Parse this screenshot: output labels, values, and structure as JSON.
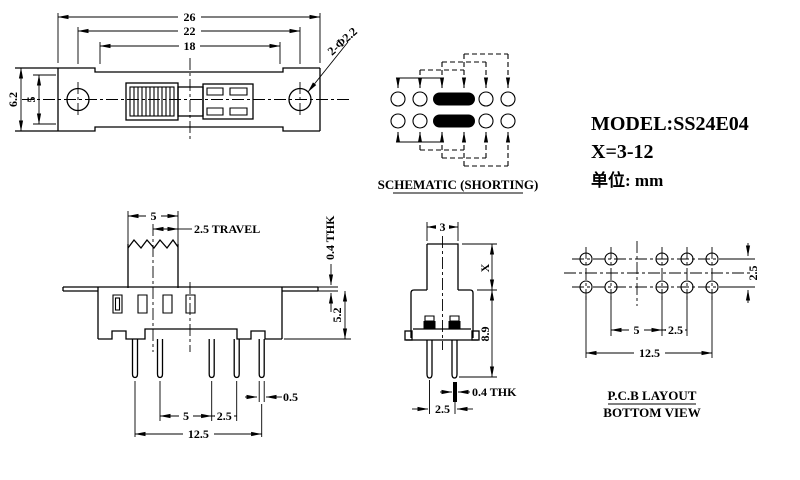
{
  "colors": {
    "ink": "#000000",
    "background": "#ffffff"
  },
  "title_block": {
    "model": "MODEL:SS24E04",
    "x_range": "X=3-12",
    "units": "单位: mm"
  },
  "top_view": {
    "dim_26": "26",
    "dim_22": "22",
    "dim_18": "18",
    "dim_62": "6.2",
    "dim_5": "5",
    "hole_callout": "2-Φ2.2"
  },
  "schematic": {
    "caption": "SCHEMATIC (SHORTING)"
  },
  "front_view": {
    "dim_knob": "5",
    "dim_travel": "2.5 TRAVEL",
    "dim_thk": "0.4 THK",
    "dim_height": "5.2",
    "dim_pitch5": "5",
    "dim_pitch25": "2.5",
    "dim_pin_w": "0.5",
    "dim_total": "12.5"
  },
  "side_view": {
    "dim_knob_w": "3",
    "dim_x": "X",
    "dim_height": "8.9",
    "dim_thk": "0.4 THK",
    "dim_pitch": "2.5"
  },
  "pcb_layout": {
    "dim_row": "2.5",
    "dim_pitch5": "5",
    "dim_pitch25": "2.5",
    "dim_total": "12.5",
    "caption_1": "P.C.B LAYOUT",
    "caption_2": "BOTTOM VIEW"
  }
}
